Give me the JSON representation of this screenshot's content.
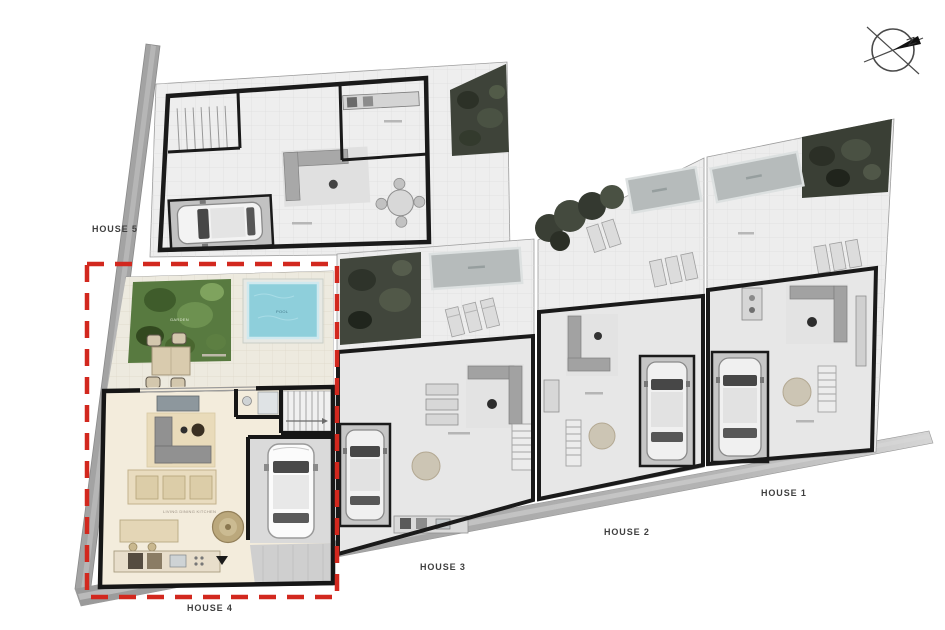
{
  "page": {
    "type": "architectural-site-plan",
    "background": "#ffffff"
  },
  "houses": [
    {
      "id": "house-1",
      "label": "HOUSE 1",
      "highlighted": false,
      "style": "grayscale"
    },
    {
      "id": "house-2",
      "label": "HOUSE 2",
      "highlighted": false,
      "style": "grayscale"
    },
    {
      "id": "house-3",
      "label": "HOUSE 3",
      "highlighted": false,
      "style": "grayscale"
    },
    {
      "id": "house-4",
      "label": "HOUSE 4",
      "highlighted": true,
      "style": "color"
    },
    {
      "id": "house-5",
      "label": "HOUSE 5",
      "highlighted": false,
      "style": "grayscale"
    }
  ],
  "highlight": {
    "house_id": "house-4",
    "border_style": "dashed",
    "border_color": "#d2281e"
  },
  "compass": {
    "label": "N"
  },
  "room_labels": {
    "pool": "POOL",
    "garden": "GARDEN",
    "living": "LIVING DINING KITCHEN"
  },
  "colors": {
    "highlight_red": "#d2281e",
    "pool_water": "#8ecfdb",
    "garden_green": "#587a40",
    "plan_gray": "#ededed",
    "floor_beige": "#f3ecdc",
    "wall_dark": "#161616",
    "road_gray": "#a3a3a3"
  }
}
